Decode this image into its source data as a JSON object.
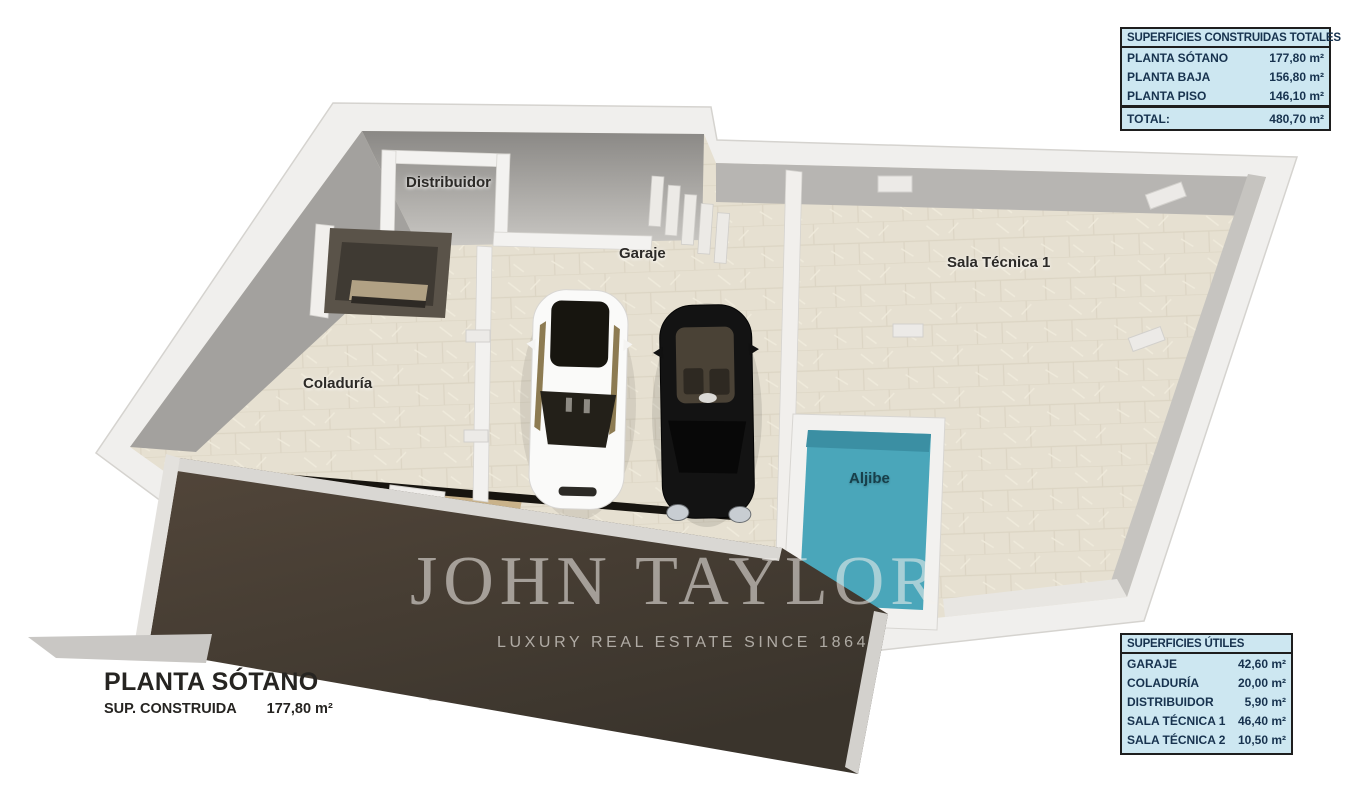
{
  "plan": {
    "title": "PLANTA SÓTANO",
    "built_label": "SUP. CONSTRUIDA",
    "built_value": "177,80 m²",
    "room_labels": {
      "distribuidor": "Distribuidor",
      "garaje": "Garaje",
      "sala_tecnica_1": "Sala Técnica 1",
      "coladuria": "Coladuría",
      "aljibe": "Aljibe"
    }
  },
  "watermark": {
    "brand": "JOHN TAYLOR",
    "tagline": "LUXURY REAL ESTATE SINCE 1864"
  },
  "tables": {
    "constructed": {
      "title": "SUPERFICIES CONSTRUIDAS TOTALES",
      "rows": [
        {
          "label": "PLANTA SÓTANO",
          "value": "177,80 m²"
        },
        {
          "label": "PLANTA BAJA",
          "value": "156,80 m²"
        },
        {
          "label": "PLANTA PISO",
          "value": "146,10 m²"
        }
      ],
      "total": {
        "label": "TOTAL:",
        "value": "480,70 m²"
      }
    },
    "useful": {
      "title": "SUPERFICIES ÚTILES",
      "rows": [
        {
          "label": "GARAJE",
          "value": "42,60 m²"
        },
        {
          "label": "COLADURÍA",
          "value": "20,00 m²"
        },
        {
          "label": "DISTRIBUIDOR",
          "value": "5,90 m²"
        },
        {
          "label": "SALA TÉCNICA 1",
          "value": "46,40 m²"
        },
        {
          "label": "SALA TÉCNICA 2",
          "value": "10,50 m²"
        }
      ]
    }
  },
  "colors": {
    "table_bg": "#cde7f1",
    "table_text": "#17324e",
    "table_border": "#1e1e1e",
    "pool_water": "#4aa6ba",
    "ramp_brown": "#46limit3b30",
    "floor_beige": "#e6e0d1",
    "wall_white": "#f0efed"
  }
}
